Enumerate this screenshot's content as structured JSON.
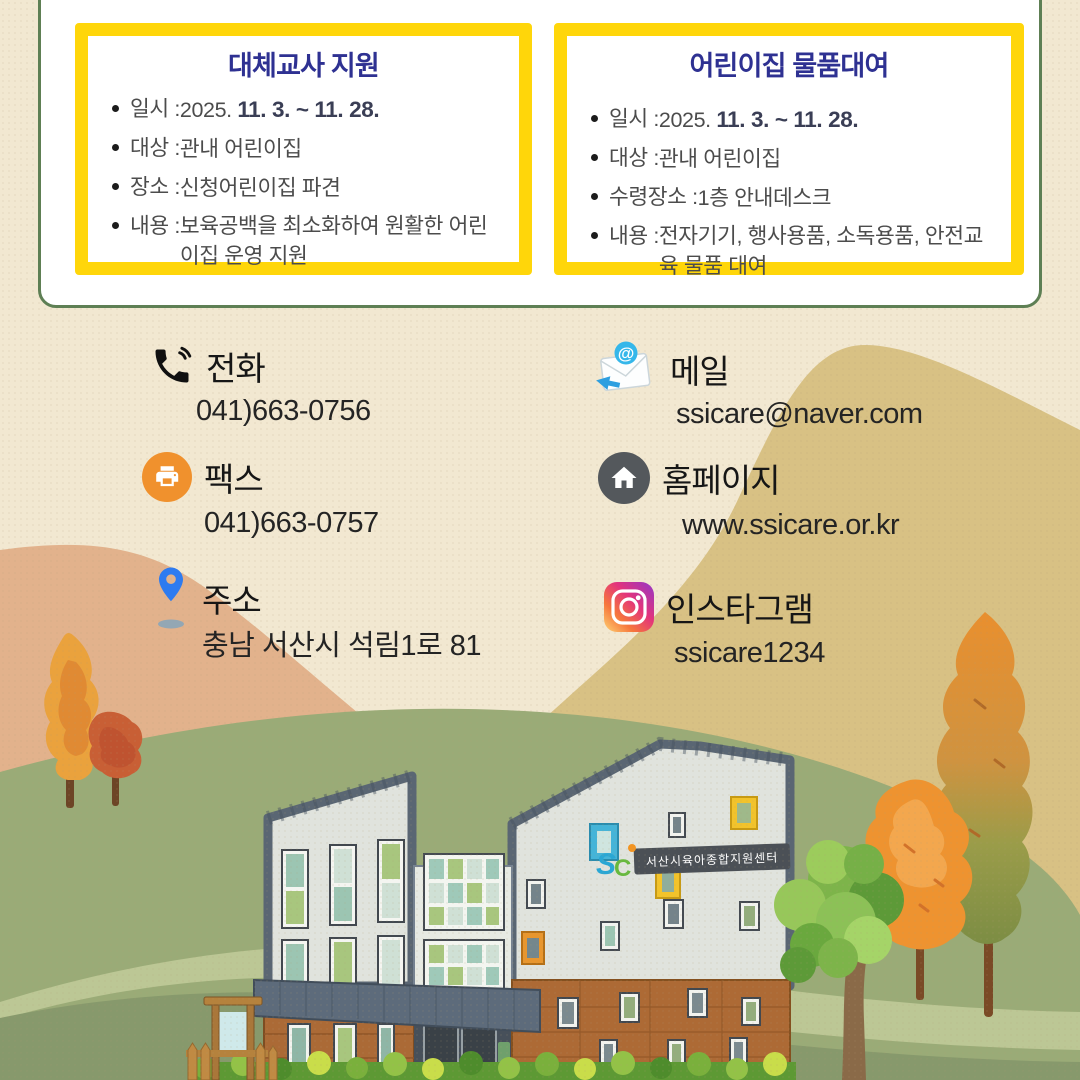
{
  "card": {
    "boxes": [
      {
        "title": "대체교사 지원",
        "items": [
          {
            "label": "일시 : ",
            "value": "2025. ",
            "strong": "11. 3. ~ 11. 28."
          },
          {
            "label": "대상 : ",
            "value": "관내 어린이집",
            "strong": ""
          },
          {
            "label": "장소 : ",
            "value": "신청어린이집 파견",
            "strong": ""
          },
          {
            "label": "내용 : ",
            "value": "보육공백을 최소화하여 원활한 어린이집 운영 지원",
            "strong": ""
          }
        ]
      },
      {
        "title": "어린이집 물품대여",
        "items": [
          {
            "label": "일시 : ",
            "value": "2025. ",
            "strong": "11. 3. ~ 11. 28."
          },
          {
            "label": "대상 : ",
            "value": "관내 어린이집",
            "strong": ""
          },
          {
            "label": "수령장소 : ",
            "value": "1층 안내데스크",
            "strong": ""
          },
          {
            "label": "내용 : ",
            "value": "전자기기, 행사용품, 소독용품, 안전교육 물품 대여",
            "strong": ""
          }
        ]
      }
    ]
  },
  "contacts": [
    {
      "icon": "phone-icon",
      "label": "전화",
      "value": "041)663-0756"
    },
    {
      "icon": "mail-icon",
      "label": "메일",
      "value": "ssicare@naver.com"
    },
    {
      "icon": "fax-icon",
      "label": "팩스",
      "value": "041)663-0757"
    },
    {
      "icon": "home-icon",
      "label": "홈페이지",
      "value": "www.ssicare.or.kr"
    },
    {
      "icon": "pin-icon",
      "label": "주소",
      "value": "충남 서산시 석림1로 81"
    },
    {
      "icon": "instagram-icon",
      "label": "인스타그램",
      "value": "ssicare1234"
    }
  ],
  "icons": {
    "mail_at": "@"
  },
  "scene": {
    "building_sign": "서산시육아종합지원센터",
    "logo_s": "S",
    "logo_c": "C"
  },
  "colors": {
    "accent_yellow": "#ffd60a",
    "title_navy": "#2e3192",
    "card_border_green": "#5e7f54",
    "fax_orange": "#f0912d",
    "pin_blue": "#2e7bf0",
    "background_cream": "#f2e8d1"
  }
}
